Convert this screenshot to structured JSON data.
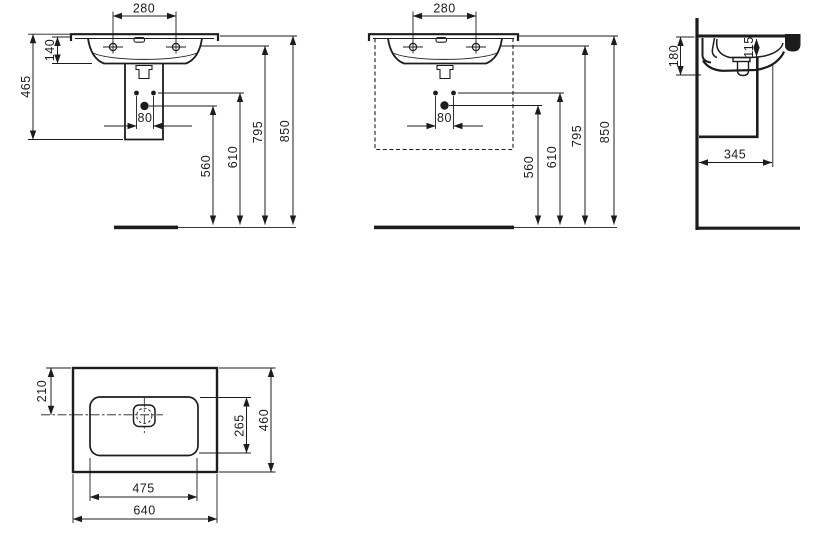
{
  "drawing": {
    "unit_values": {
      "front": {
        "tap_hole_spacing": "280",
        "basin_height": "140",
        "under_basin_height": "465",
        "fixing_hole_spacing": "80",
        "waste_outlet_height": "560",
        "fixing_holes_height": "610",
        "rim_underside_height": "795",
        "rim_top_height": "850"
      },
      "front_cabinet": {
        "tap_hole_spacing": "280",
        "fixing_hole_spacing": "80",
        "waste_outlet_height": "560",
        "fixing_holes_height": "610",
        "rim_underside_height": "795",
        "rim_top_height": "850"
      },
      "side": {
        "front_edge_height": "180",
        "bowl_inner_depth": "115",
        "wall_projection": "345"
      },
      "plan": {
        "waste_center_offset": "210",
        "bowl_inner_depth": "265",
        "overall_depth": "460",
        "bowl_inner_width": "475",
        "overall_width": "640"
      }
    }
  }
}
